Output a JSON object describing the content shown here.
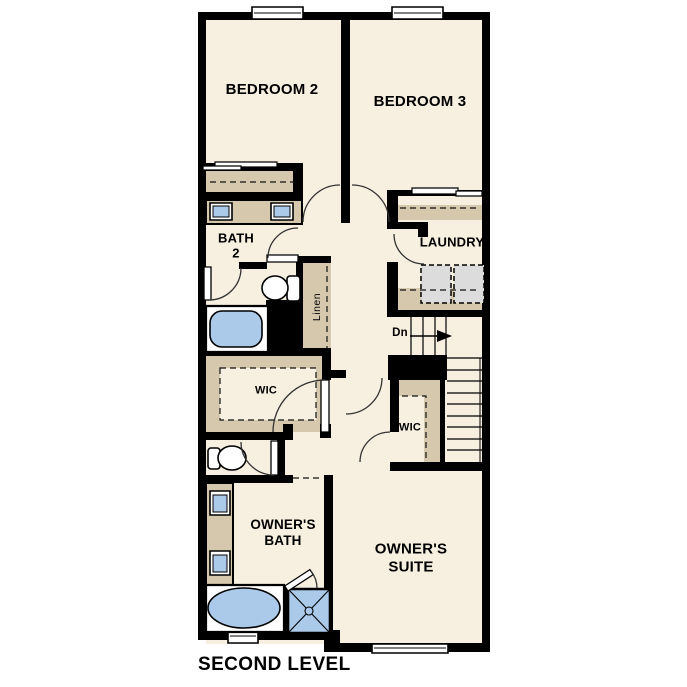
{
  "title": "SECOND LEVEL",
  "colors": {
    "floor": "#f7efe0",
    "counter_tan": "#d5c8ac",
    "fixture_blue": "#abc9e8",
    "appliance_gray": "#dcdcdc",
    "wall_black": "#000000",
    "line_dark": "#1a1a1a"
  },
  "rooms": {
    "bedroom2": {
      "label": "BEDROOM 2"
    },
    "bedroom3": {
      "label": "BEDROOM 3"
    },
    "bath2": {
      "line1": "BATH",
      "line2": "2"
    },
    "laundry": {
      "label": "LAUNDRY"
    },
    "linen": {
      "label": "Linen"
    },
    "wic_left": {
      "label": "WIC"
    },
    "wic_right": {
      "label": "WIC"
    },
    "owners_bath": {
      "line1": "OWNER'S",
      "line2": "BATH"
    },
    "owners_suite": {
      "line1": "OWNER'S",
      "line2": "SUITE"
    }
  },
  "stairs": {
    "direction_label": "Dn"
  }
}
